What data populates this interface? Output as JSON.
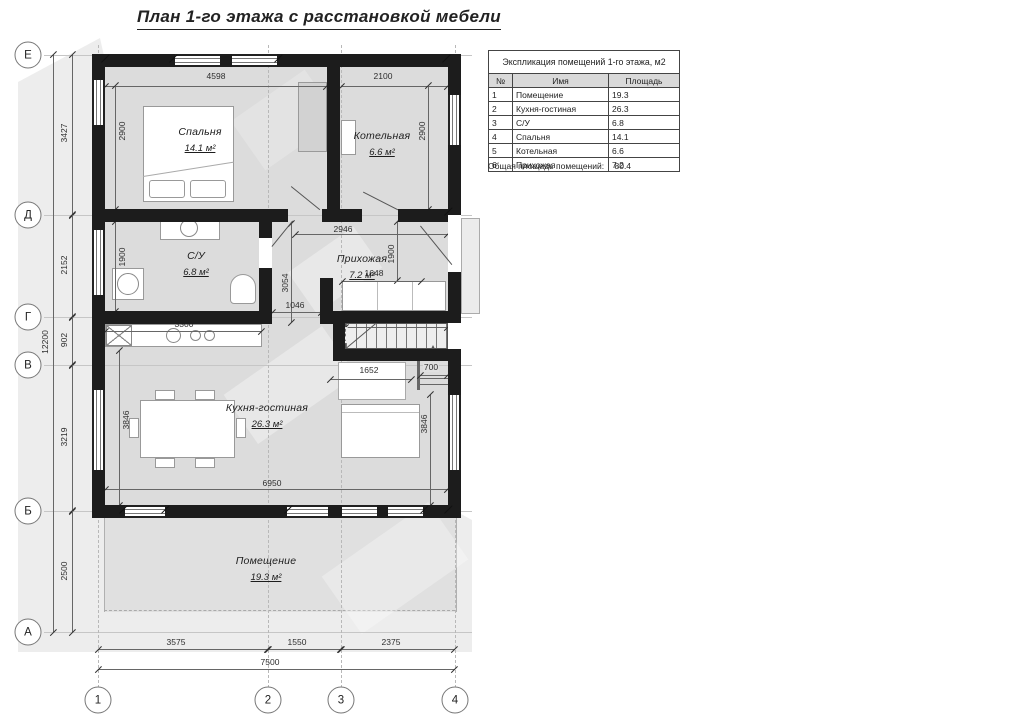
{
  "title": "План 1-го этажа с расстановкой мебели",
  "table": {
    "title": "Экспликация помещений 1-го этажа, м2",
    "col_num": "№",
    "col_name": "Имя",
    "col_area": "Площадь",
    "rows": [
      [
        "1",
        "Помещение",
        "19.3"
      ],
      [
        "2",
        "Кухня-гостиная",
        "26.3"
      ],
      [
        "3",
        "С/У",
        "6.8"
      ],
      [
        "4",
        "Спальня",
        "14.1"
      ],
      [
        "5",
        "Котельная",
        "6.6"
      ],
      [
        "6",
        "Прихожая",
        "7.2"
      ]
    ],
    "total_label": "Общая площадь помещений:",
    "total_value": "80.4"
  },
  "axes": {
    "rows": [
      "Е",
      "Д",
      "Г",
      "В",
      "Б",
      "А"
    ],
    "cols": [
      "1",
      "2",
      "3",
      "4"
    ]
  },
  "rooms": [
    {
      "name": "Спальня",
      "area": "14.1 м²"
    },
    {
      "name": "Котельная",
      "area": "6.6 м²"
    },
    {
      "name": "С/У",
      "area": "6.8 м²"
    },
    {
      "name": "Прихожая",
      "area": "7.2 м²"
    },
    {
      "name": "Кухня-гостиная",
      "area": "26.3 м²"
    },
    {
      "name": "Помещение",
      "area": "19.3 м²"
    }
  ],
  "dims": {
    "overall_v": "12200",
    "seg_v": [
      "3427",
      "2152",
      "902",
      "3219",
      "2500"
    ],
    "overall_h": "7500",
    "seg_h": [
      "3575",
      "1550",
      "2375"
    ],
    "bedroom_w": "4598",
    "bedroom_h": "2900",
    "boiler_w": "2100",
    "boiler_h": "2900",
    "su_h": "1900",
    "hall_w": "2946",
    "hall_h": "1900",
    "wardrobe_w": "1648",
    "corridor_h": "3054",
    "corridor_w": "1046",
    "counter_w": "3300",
    "kitchen_h_left": "3846",
    "kitchen_h_right": "3846",
    "stairs_w": "2100",
    "stairs_h": "700",
    "opening_w": "1652",
    "ladder_w": "700",
    "kitchen_w": "6950"
  },
  "colors": {
    "wall": "#1c1c1c",
    "floor": "#dcdcdc",
    "shadow": "#ededed",
    "dim_line": "#666666"
  }
}
